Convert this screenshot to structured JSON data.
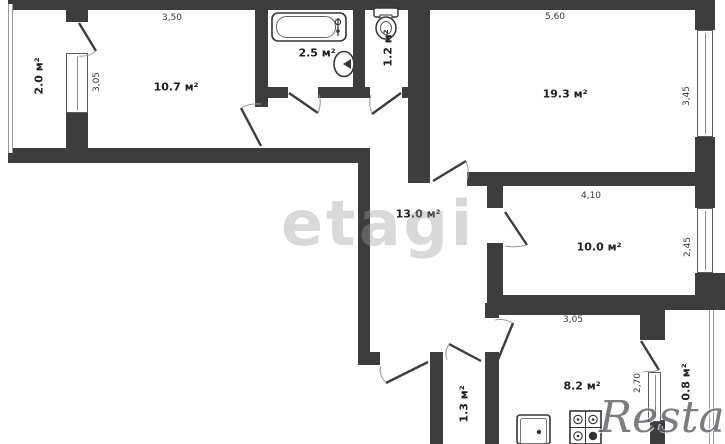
{
  "watermarks": {
    "center": "etagi",
    "corner": "Restate"
  },
  "rooms": {
    "balcony_left": "2.0 м²",
    "room_top_left": "10.7 м²",
    "bathroom": "2.5 м²",
    "wc": "1.2 м²",
    "living": "19.3 м²",
    "hallway": "13.0 м²",
    "bedroom": "10.0 м²",
    "kitchen": "8.2 м²",
    "closet": "1.3 м²",
    "balcony_right": "0.8 м²"
  },
  "dims": {
    "room_top_left_w": "3,50",
    "room_top_left_h": "3,05",
    "living_w": "5,60",
    "living_h": "3,45",
    "bedroom_w": "4,10",
    "bedroom_h": "2,45",
    "kitchen_w": "3,05",
    "kitchen_h": "2,70"
  }
}
